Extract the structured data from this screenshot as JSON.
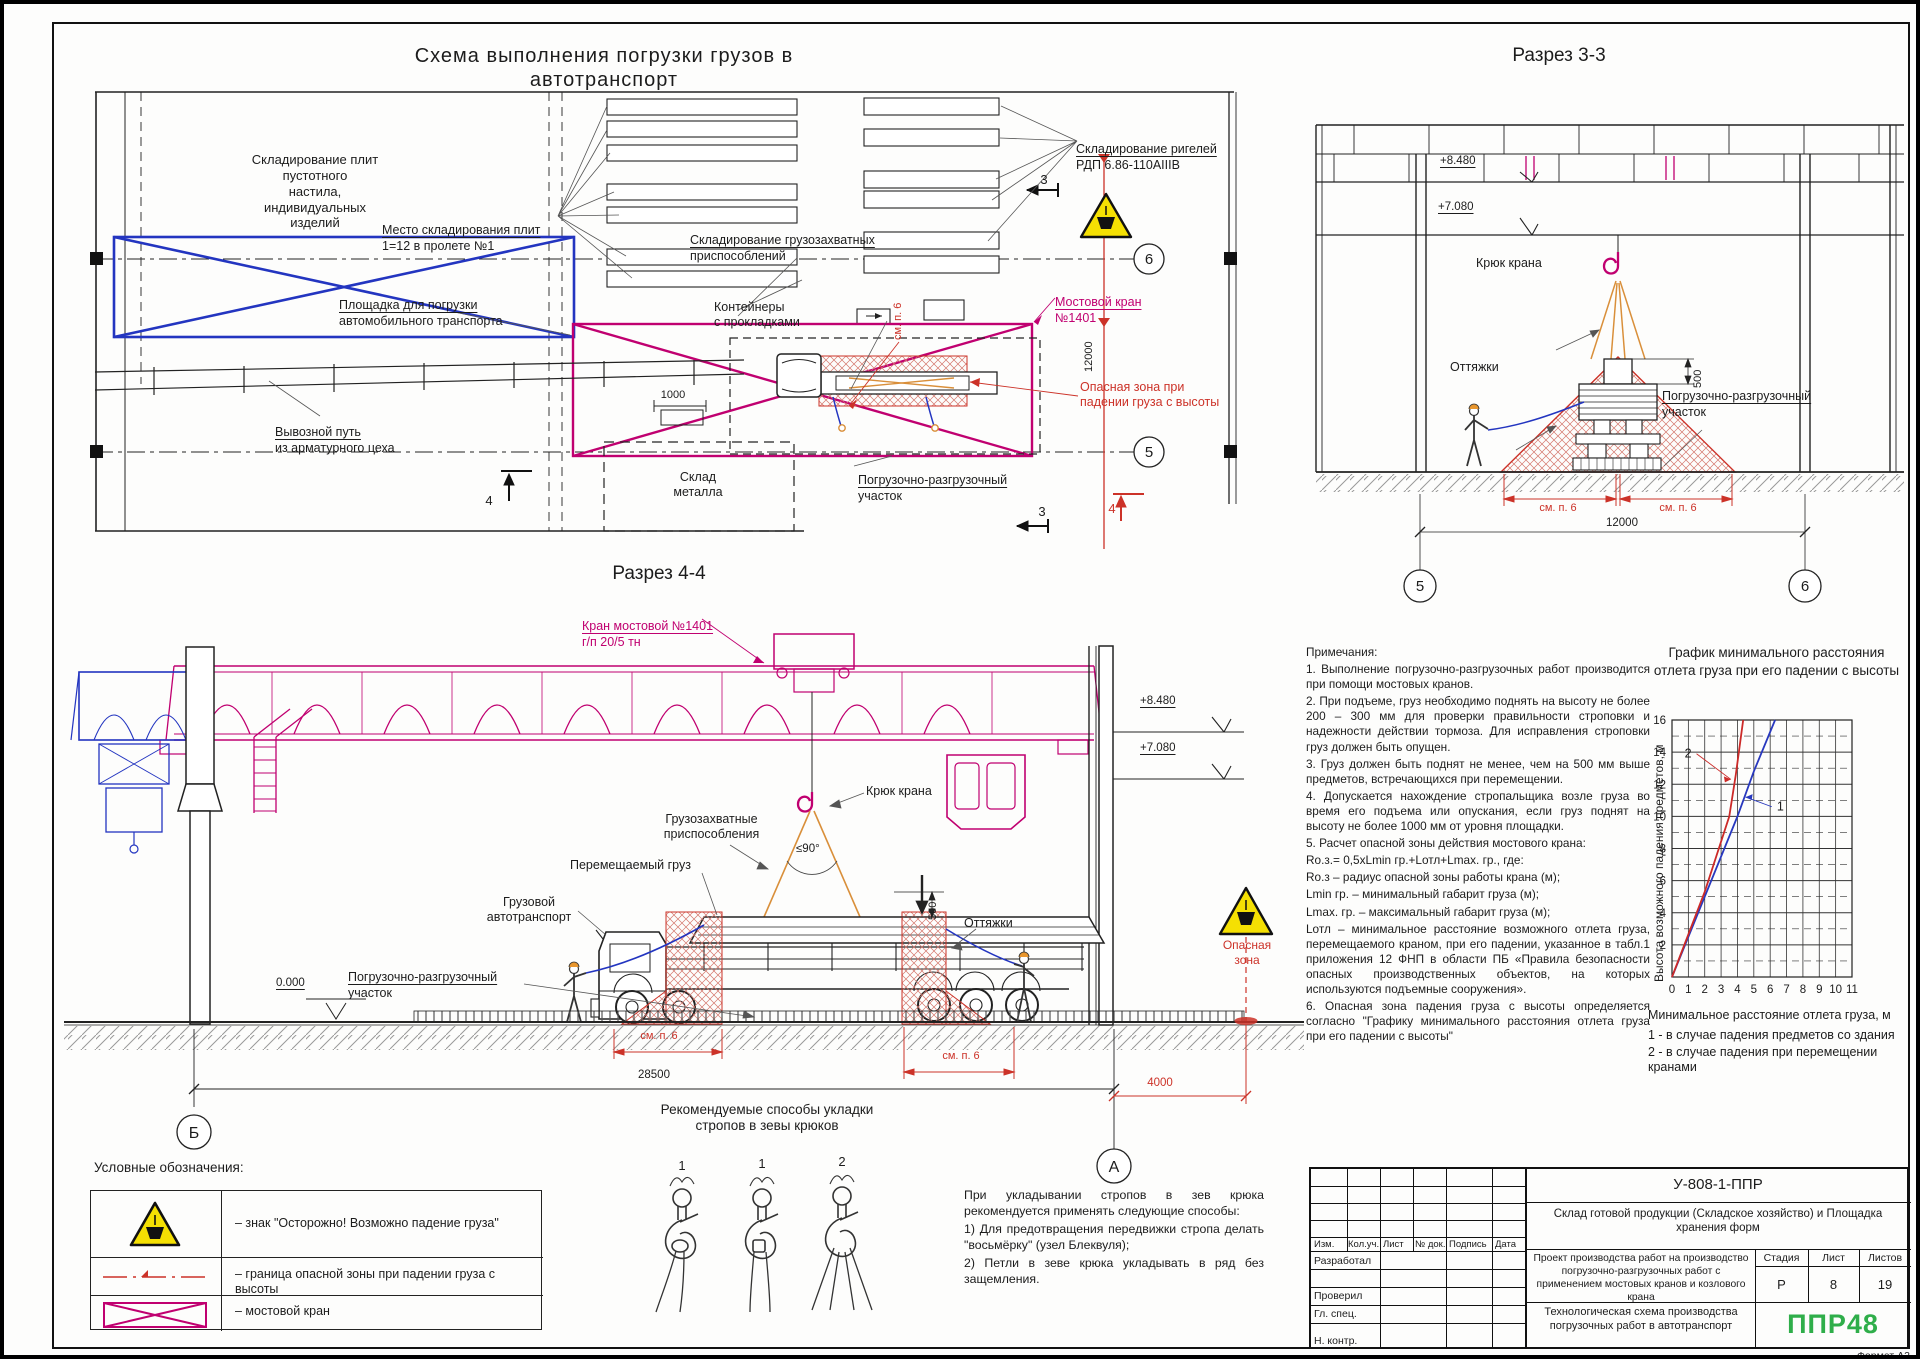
{
  "titles": {
    "main": "Схема выполнения погрузки грузов в автотранспорт",
    "section33": "Разрез 3-3",
    "section44": "Разрез 4-4"
  },
  "plan": {
    "slab_storage": "Складирование плит\nпустотного\nнастила,\nиндивидуальных\nизделий",
    "slab_place_l1": "Место складирования плит",
    "slab_place_l2": "1=12 в пролете №1",
    "loading_area_l1": "Площадка для погрузки",
    "loading_area_l2": "автомобильного транспорта",
    "rigging_l1": "Складирование грузозахватных",
    "rigging_l2": "приспособлений",
    "containers": "Контейнеры\nс прокладками",
    "girders_l1": "Складирование ригелей",
    "girders_l2": "РДП 6.86-110АIIIВ",
    "crane_l1": "Мостовой кран",
    "crane_l2": "№1401",
    "danger_zone": "Опасная зона при\nпадении груза с высоты",
    "rail_l1": "Вывозной путь",
    "rail_l2": "из арматурного цеха",
    "load_section_l1": "Погрузочно-разгрузочный",
    "load_section_l2": "участок",
    "metal_store": "Склад\nметалла",
    "dim_1000": "1000",
    "dim_12000": "12000",
    "see_p6": "см. п. 6",
    "ax6": "6",
    "ax5": "5",
    "sec3": "3",
    "sec4": "4"
  },
  "section33": {
    "level1": "+8.480",
    "level2": "+7.080",
    "hook": "Крюк крана",
    "guys": "Оттяжки",
    "load_section_l1": "Погрузочно-разгрузочный",
    "load_section_l2": "участок",
    "dim500": "500",
    "see_p6": "см. п. 6",
    "dim12000": "12000",
    "ax5": "5",
    "ax6": "6"
  },
  "section44": {
    "crane_l1": "Кран мостовой №1401",
    "crane_l2": "г/п 20/5 тн",
    "level1": "+8.480",
    "level2": "+7.080",
    "hook": "Крюк крана",
    "rigging": "Грузозахватные\nприспособления",
    "angle": "≤90°",
    "moved_load": "Перемещаемый груз",
    "truck": "Грузовой\nавтотранспорт",
    "load_section_l1": "Погрузочно-разгрузочный",
    "load_section_l2": "участок",
    "guys": "Оттяжки",
    "level0": "0.000",
    "dim500": "500",
    "see_p6": "см. п. 6",
    "dim28500": "28500",
    "dim4000": "4000",
    "danger": "Опасная\nзона",
    "axB": "Б",
    "axA": "А"
  },
  "notes": {
    "title": "Примечания:",
    "items": [
      "1.  Выполнение погрузочно-разгрузочных работ производится при помощи мостовых кранов.",
      "2.  При подъеме, груз необходимо поднять на высоту не более 200 – 300 мм для проверки правильности строповки и надежности действии тормоза. Для исправления строповки груз должен быть опущен.",
      "3. Груз должен быть поднят не менее, чем на 500 мм выше предметов, встречающихся при перемещении.",
      "4.  Допускается нахождение стропальщика возле груза во время его подъема или опускания, если груз поднят на высоту не более 1000 мм от уровня площадки.",
      "5.  Расчет опасной зоны действия мостового крана:",
      "Rо.з.= 0,5хLmin гр.+Lотл+Lmax. гр., где:",
      "Rо.з – радиус опасной зоны работы крана (м);",
      "Lmin гр. – минимальный габарит груза (м);",
      "Lmax. гр. – максимальный габарит груза (м);",
      "Lотл – минимальное расстояние возможного отлета груза, перемещаемого краном, при его падении, указанное в табл.1 приложения 12  ФНП в области ПБ «Правила безопасности опасных производственных объектов, на которых используются подъемные сооружения».",
      "6. Опасная зона падения груза с высоты определяется согласно \"Графику минимального расстояния отлета груза при его падении с высоты\""
    ]
  },
  "hooks": {
    "title": "Рекомендуемые способы укладки\nстропов в зевы крюков",
    "labels": [
      "1",
      "1",
      "2"
    ],
    "text": [
      "При укладывании стропов в зев крюка рекомендуется применять следующие способы:",
      "1)    Для предотвращения передвижки стропа делать \"восьмёрку\" (узел Блеквуля);",
      "2)    Петли в зеве крюка укладывать в ряд без защемления."
    ]
  },
  "legend": {
    "title": "Условные обозначения:",
    "items": [
      "– знак \"Осторожно! Возможно падение груза\"",
      "– граница опасной зоны при падении груза с высоты",
      "– мостовой кран"
    ]
  },
  "chart_data": {
    "type": "line",
    "title": "График минимального расстояния отлета груза при его падении с высоты",
    "ylabel": "Высота возможного падения предметов, м",
    "xlabel": "Минимальное расстояние отлета груза, м",
    "xlim": [
      0,
      11
    ],
    "ylim": [
      0,
      16
    ],
    "xticks": [
      0,
      1,
      2,
      3,
      4,
      5,
      6,
      7,
      8,
      9,
      10,
      11
    ],
    "yticks": [
      2,
      4,
      6,
      8,
      10,
      12,
      14,
      16
    ],
    "grid": true,
    "legend_lines": [
      "1 - в случае падения предметов со здания",
      "2 - в случае падения при перемещении кранами"
    ],
    "series": [
      {
        "name": "1",
        "color": "#2838be",
        "points": [
          [
            0,
            0
          ],
          [
            2,
            5
          ],
          [
            4,
            10
          ],
          [
            5,
            12.8
          ],
          [
            6.3,
            16
          ]
        ],
        "label_at": [
          6.1,
          10.6
        ],
        "label_target": [
          4.5,
          11.2
        ]
      },
      {
        "name": "2",
        "color": "#cc2a28",
        "points": [
          [
            0,
            0
          ],
          [
            2,
            5.3
          ],
          [
            3.5,
            10
          ],
          [
            3.9,
            12.6
          ],
          [
            4.35,
            16
          ]
        ],
        "label_at": [
          1.5,
          13.9
        ],
        "label_target": [
          3.6,
          12.3
        ]
      }
    ]
  },
  "titleblock": {
    "doc_number": "У-808-1-ППР",
    "object": "Склад готовой продукции (Складское хозяйство) и Площадка хранения форм",
    "project": "Проект производства работ на производство погрузочно-разгрузочных работ с применением мостовых кранов и козлового крана",
    "scheme": "Технологическая схема производства погрузочных работ в автотранспорт",
    "col_izm": "Изм.",
    "col_koluch": "Кол.уч.",
    "col_list": "Лист",
    "col_ndok": "№ док.",
    "col_podpis": "Подпись",
    "col_data": "Дата",
    "role_dev": "Разработал",
    "role_check": "Проверил",
    "role_chief": "Гл. спец.",
    "role_ncontr": "Н. контр.",
    "stage_label": "Стадия",
    "sheet_label": "Лист",
    "sheets_label": "Листов",
    "stage": "Р",
    "sheet": "8",
    "sheets": "19",
    "logo": "ППР48",
    "format_note": "Формат А2"
  },
  "colors": {
    "crane_magenta": "#c00070",
    "zone_blue": "#2335c0",
    "danger_red": "#cc3228",
    "sling_orange": "#d98f3a",
    "sign_yellow": "#f5e003",
    "logo_green": "#2fae4a"
  }
}
